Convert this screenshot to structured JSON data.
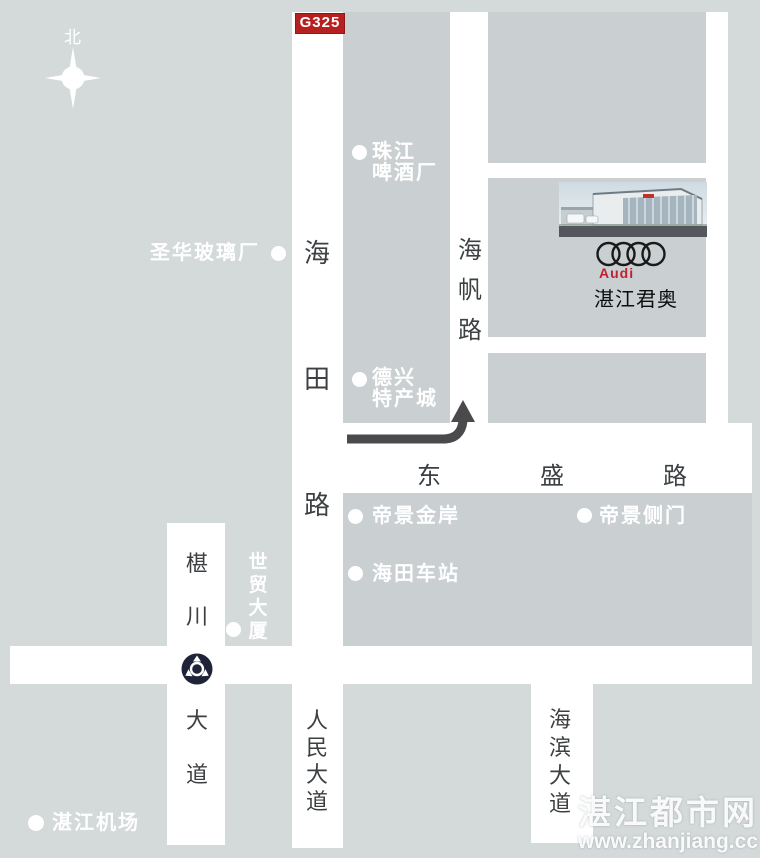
{
  "compass": {
    "north_label": "北"
  },
  "highway_badge": {
    "label": "G325"
  },
  "roads": {
    "haitian": {
      "name": "海田路"
    },
    "haifan": {
      "name": "海帆路"
    },
    "dongsheng": {
      "name": "东盛路"
    },
    "shenchuan": {
      "part1": "椹川",
      "part2": "大道"
    },
    "renmin": {
      "name": "人民大道"
    },
    "haibin": {
      "name": "海滨大道"
    }
  },
  "dealer": {
    "brand_label": "Audi",
    "name": "湛江君奥"
  },
  "pois": {
    "zhujiang_brewery": {
      "line1": "珠江",
      "line2": "啤酒厂"
    },
    "shenghua_glass": {
      "label": "圣华玻璃厂"
    },
    "dexing_market": {
      "line1": "德兴",
      "line2": "特产城"
    },
    "dijing_jinan": {
      "label": "帝景金岸"
    },
    "dijing_side_gate": {
      "label": "帝景侧门"
    },
    "haitian_station": {
      "label": "海田车站"
    },
    "shimao_tower": {
      "label": "世贸大厦"
    },
    "airport": {
      "label": "湛江机场"
    }
  },
  "watermark": {
    "line1": "湛江都市网",
    "line2": "www.zhanjiang.cc"
  },
  "colors": {
    "background": "#d4d9da",
    "city_block": "#cad0d2",
    "road_white": "#ffffff",
    "badge_red": "#b6211f",
    "audi_red": "#c21f30",
    "roundabout_navy": "#1e2338",
    "route_arrow_gray": "#4a4a4c",
    "road_text": "#3c4042",
    "poi_text": "#ffffff"
  }
}
